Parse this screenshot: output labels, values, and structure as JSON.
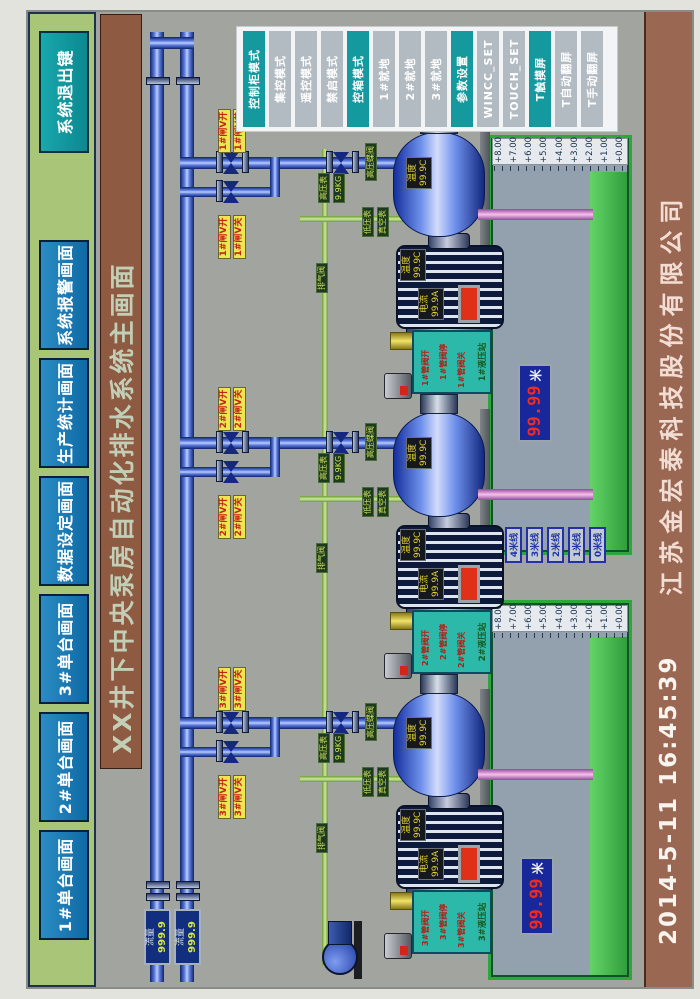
{
  "nav": {
    "buttons": [
      "1#单台画面",
      "2#单台画面",
      "3#单台画面",
      "数据设定画面",
      "生产统计画面",
      "系统报警画面"
    ],
    "exit_label": "系统退出键"
  },
  "title": "XX井下中央泵房自动化排水系统主画面",
  "mode_panel": {
    "buttons": [
      "控制柜模式",
      "集控模式",
      "遥控模式",
      "禁启模式",
      "控箱模式",
      "1#就地",
      "2#就地",
      "3#就地",
      "参数设置",
      "WINCC_SET",
      "TOUCH_SET",
      "T触摸屏",
      "T自动翻屏",
      "T手动翻屏"
    ]
  },
  "mains": {
    "flow_label": "流量",
    "flow1_value": "999.9",
    "flow2_value": "999.9"
  },
  "pumps": [
    {
      "id": "3#",
      "gate_open": "3#闸V开",
      "gate_close": "3#闸V关",
      "hp_valve": "高压蝶阀",
      "hp_gauge": "高压表",
      "hp_value": "9.9KG",
      "lp_gauge": "低压表",
      "vac_gauge": "真空表",
      "vent": "排气阀",
      "pump_temp_label": "温度",
      "pump_temp_value": "99.9C",
      "motor_temp_label": "温度",
      "motor_temp_value": "99.9C",
      "motor_current_label": "电流",
      "motor_current_value": "99.9A",
      "hyd_station": "3#液压站",
      "valve_open": "3#管阀开",
      "valve_stop": "3#管阀停",
      "valve_close": "3#管阀关"
    },
    {
      "id": "2#",
      "gate_open": "2#闸V开",
      "gate_close": "2#闸V关",
      "hp_valve": "高压蝶阀",
      "hp_gauge": "高压表",
      "hp_value": "9.9KG",
      "lp_gauge": "低压表",
      "vac_gauge": "真空表",
      "vent": "排气阀",
      "pump_temp_label": "温度",
      "pump_temp_value": "99.9C",
      "motor_temp_label": "温度",
      "motor_temp_value": "99.9C",
      "motor_current_label": "电流",
      "motor_current_value": "99.9A",
      "hyd_station": "2#液压站",
      "valve_open": "2#管阀开",
      "valve_stop": "2#管阀停",
      "valve_close": "2#管阀关"
    },
    {
      "id": "1#",
      "gate_open": "1#闸V开",
      "gate_close": "1#闸V关",
      "hp_valve": "高压蝶阀",
      "hp_gauge": "高压表",
      "hp_value": "9.9KG",
      "lp_gauge": "低压表",
      "vac_gauge": "真空表",
      "vent": "排气阀",
      "pump_temp_label": "温度",
      "pump_temp_value": "99.9C",
      "motor_temp_label": "温度",
      "motor_temp_value": "99.9C",
      "motor_current_label": "电流",
      "motor_current_value": "99.9A",
      "hyd_station": "1#液压站",
      "valve_open": "1#管阀开",
      "valve_stop": "1#管阀停",
      "valve_close": "1#管阀关"
    }
  ],
  "sumps": {
    "scale": [
      "+8.00",
      "+7.00",
      "+6.00",
      "+5.00",
      "+4.00",
      "+3.00",
      "+2.00",
      "+1.00",
      "+0.00"
    ],
    "left_level": "99.99",
    "right_level": "99.99",
    "unit": "米"
  },
  "level_lines": [
    "4米线",
    "3米线",
    "2米线",
    "1米线",
    "0米线"
  ],
  "footer": {
    "datetime": "2014-5-11  16:45:39",
    "company": "江苏金宏泰科技股份有限公司"
  },
  "colors": {
    "accent_teal": "#149a9e",
    "nav_blue": "#0f6aa4",
    "bar_green": "#a9c678",
    "title_brown": "#8e5a42",
    "alarm_red": "#e03018",
    "water_green": "#2f9e3c"
  }
}
